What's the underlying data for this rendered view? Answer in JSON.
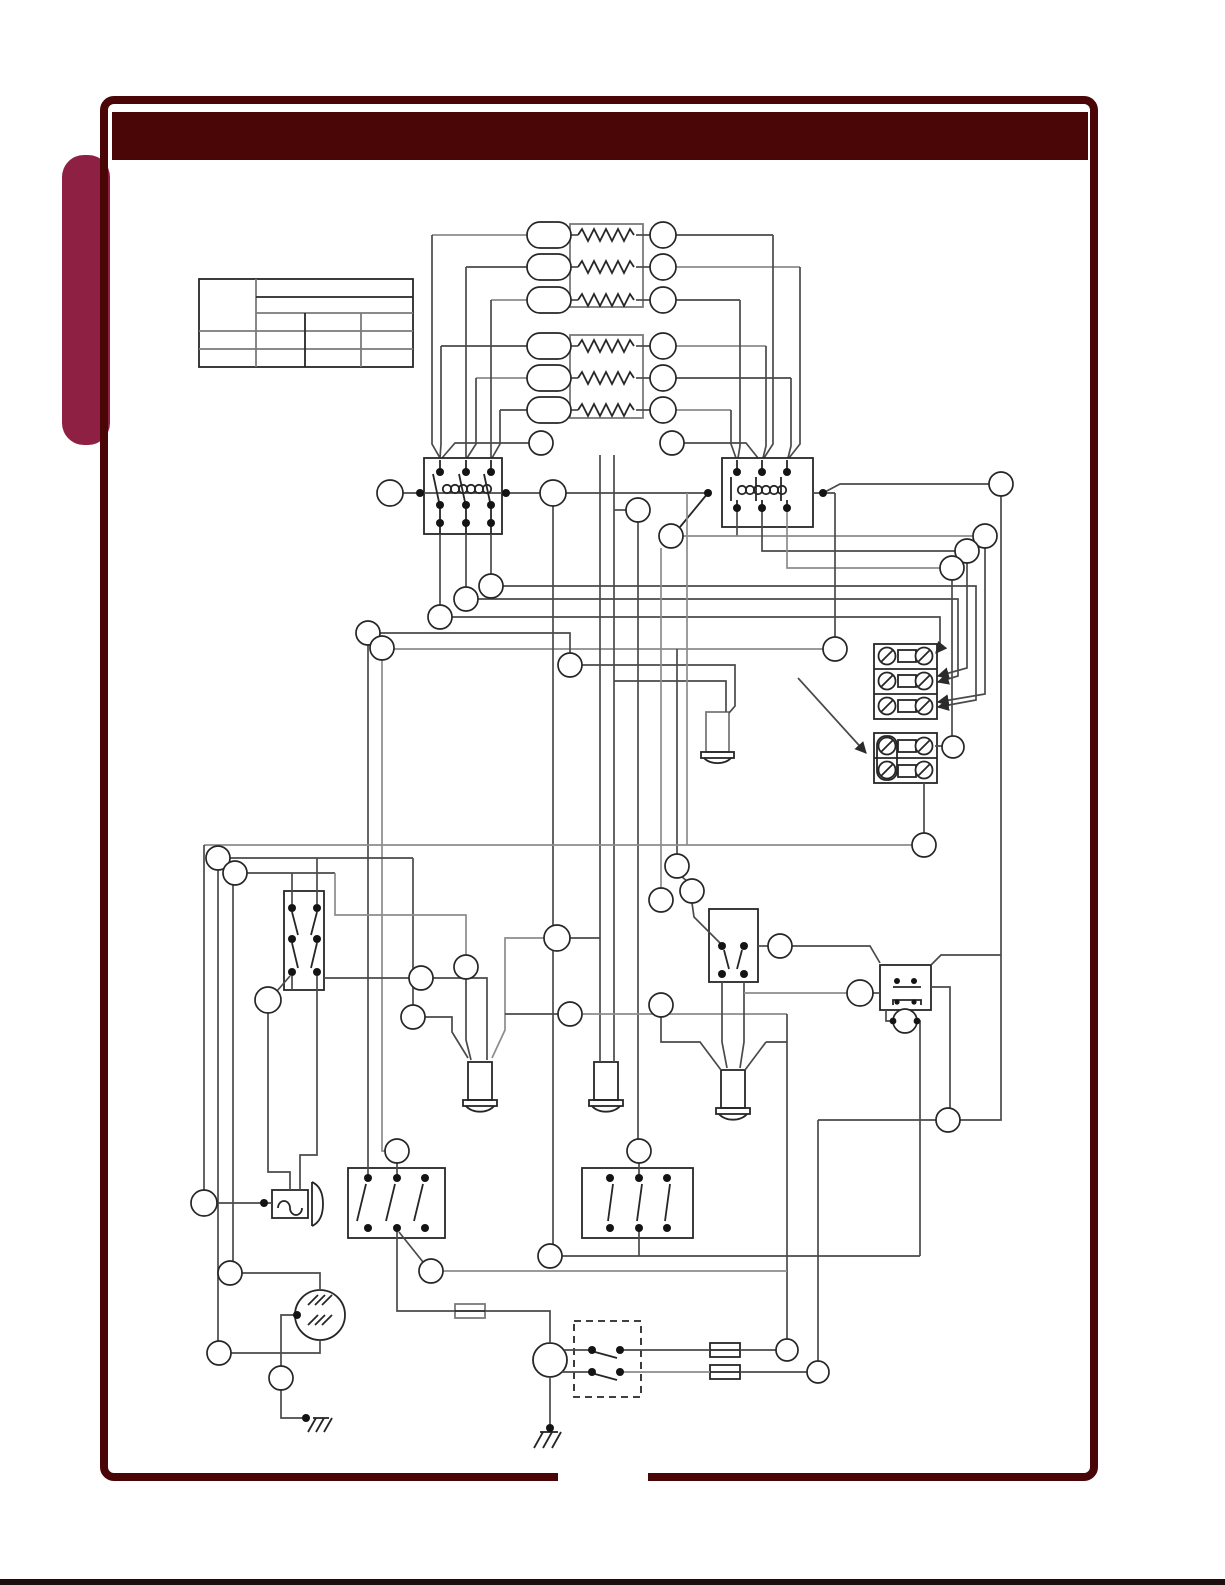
{
  "frame": {
    "background": "#ffffff",
    "border_color": "#4a0507",
    "header_color": "#4a0507",
    "tab_color": "#8e2143",
    "page_bottom_edge_color": "#1c0f10",
    "bottom_border_gap": true
  },
  "diagram": {
    "wire_color": "#4a4a4a",
    "wire_color_soft": "#8c8c8c",
    "component_color": "#262626",
    "text_present": false,
    "spec_table": {
      "rows": 3,
      "columns": 4,
      "all_cells_empty": true
    },
    "wire_labels": {
      "oval_count": 6,
      "circle_count": 51,
      "all_empty": true
    },
    "components": [
      {
        "name": "heater-bank-1",
        "type": "resistor-bank",
        "elements": 3
      },
      {
        "name": "heater-bank-2",
        "type": "resistor-bank",
        "elements": 3
      },
      {
        "name": "contactor-left",
        "type": "contactor-3-pole-with-coil"
      },
      {
        "name": "contactor-right",
        "type": "contactor-3-pole-with-coil"
      },
      {
        "name": "terminal-block-upper",
        "type": "screw-terminal-block",
        "positions": 3
      },
      {
        "name": "terminal-block-lower",
        "type": "screw-terminal-block",
        "positions": 2,
        "jumpered": true
      },
      {
        "name": "probe-upper",
        "type": "temperature-probe"
      },
      {
        "name": "probe-lower-left",
        "type": "temperature-probe"
      },
      {
        "name": "probe-lower-center",
        "type": "temperature-probe"
      },
      {
        "name": "probe-lower-right",
        "type": "temperature-probe"
      },
      {
        "name": "switch-dpdt-left",
        "type": "switch-2-pole-3-position"
      },
      {
        "name": "switch-3-pole-left",
        "type": "switch-3-pole-open"
      },
      {
        "name": "switch-3-pole-right",
        "type": "switch-3-pole-closed"
      },
      {
        "name": "switch-dpst-right",
        "type": "switch-2-pole-with-actuator"
      },
      {
        "name": "relay-contact-block",
        "type": "relay"
      },
      {
        "name": "buzzer",
        "type": "buzzer"
      },
      {
        "name": "motor",
        "type": "motor-with-internal-hatch"
      },
      {
        "name": "transformer-circle",
        "type": "round-power-component"
      },
      {
        "name": "enclosed-switch",
        "type": "switch-pair-in-dashed-enclosure"
      },
      {
        "name": "fuse-1",
        "type": "fuse"
      },
      {
        "name": "fuse-2",
        "type": "fuse"
      },
      {
        "name": "fuse-3",
        "type": "fuse"
      },
      {
        "name": "ground-left",
        "type": "earth-ground"
      },
      {
        "name": "ground-center",
        "type": "earth-ground"
      }
    ]
  }
}
